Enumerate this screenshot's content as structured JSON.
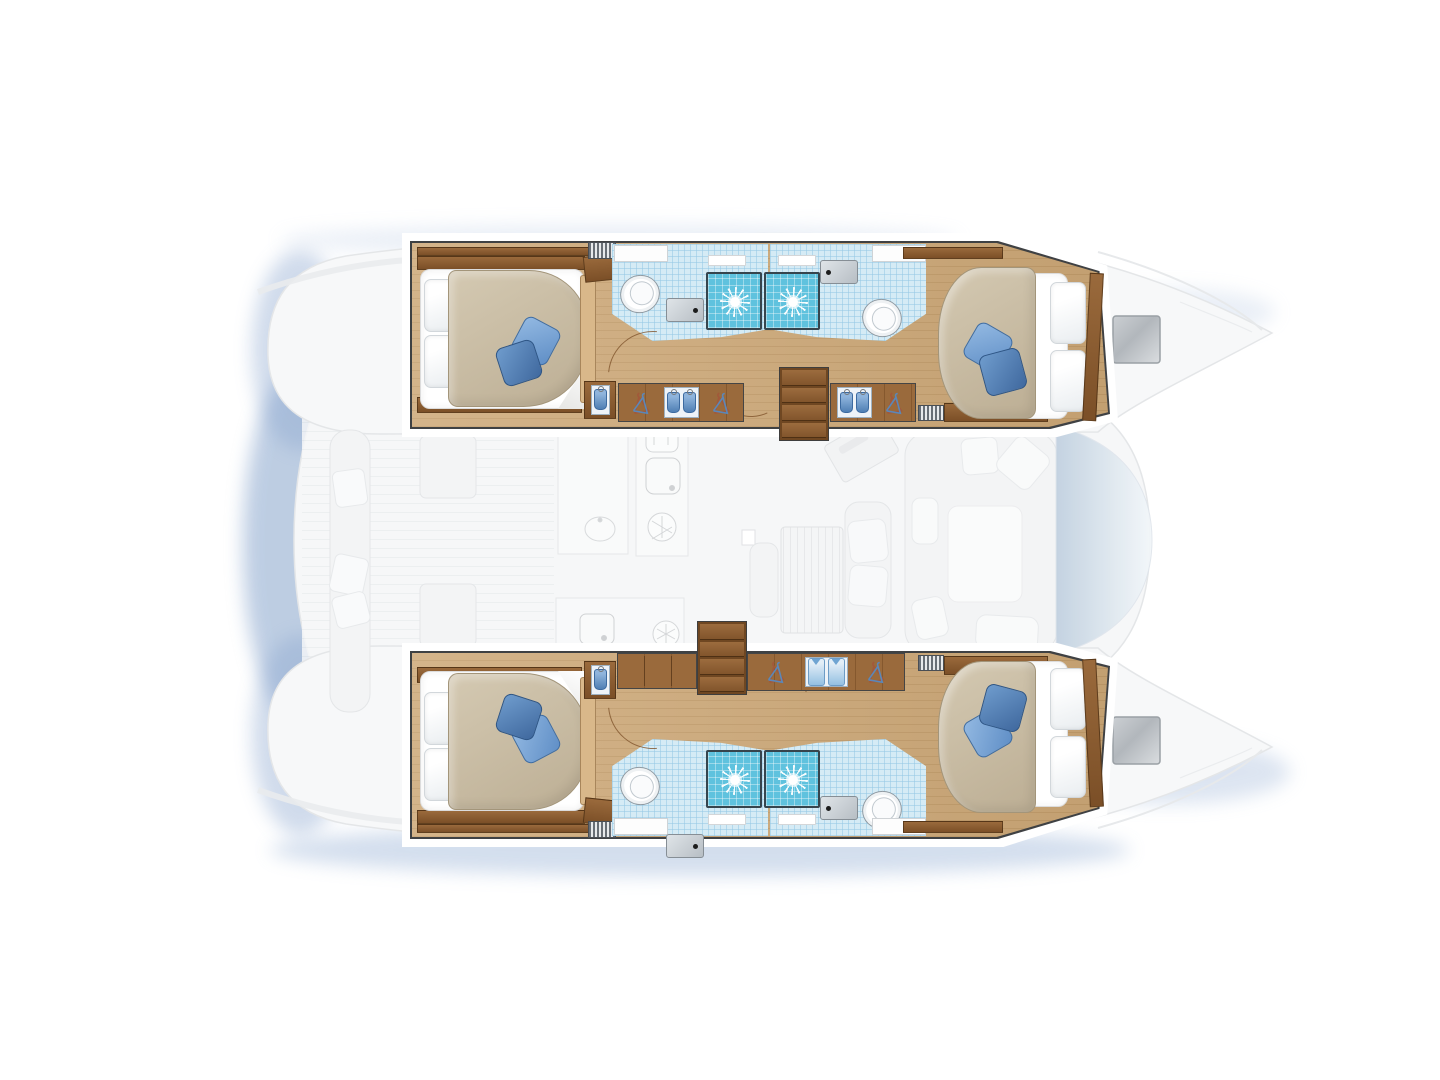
{
  "page": {
    "title": "Catamaran 4-cabin layout — top-view floor plan",
    "view": "top-down, bow to the right",
    "background": "#ffffff"
  },
  "legend": {
    "hulls": 2,
    "double_cabins": 4,
    "bathrooms": 4,
    "showers": 4,
    "toilets": 4,
    "sinks": 4,
    "companionway_steps": 2
  },
  "palette": {
    "wood_floor": "#c9a26e",
    "wood_dark": "#7b4f27",
    "bath_tile": "#d5ebf5",
    "shower_tile": "#5fc2de",
    "cushion_blue_light": "#6f9dd1",
    "cushion_blue_dark": "#40699f",
    "duvet_beige": "#c8bda6",
    "linen_white": "#ffffff",
    "ghost_deck": "#f6f7f8",
    "ghost_line": "#e4e6e8",
    "glass_blue": "#bfcfdf",
    "shadow_blue": "#7d9cc7",
    "outline_dark": "#3f4143"
  },
  "rooms": {
    "port_hull": {
      "label": "Port hull (top)",
      "aft_cabin": "Port aft double cabin",
      "fwd_cabin": "Port forward double cabin",
      "aft_bath": "Port aft bathroom with shower",
      "fwd_bath": "Port forward bathroom with shower",
      "entry": "Port companionway steps",
      "wardrobe": "Port hanging lockers"
    },
    "starboard_hull": {
      "label": "Starboard hull (bottom)",
      "aft_cabin": "Starboard aft double cabin",
      "fwd_cabin": "Starboard forward double cabin",
      "aft_bath": "Starboard aft bathroom with shower",
      "fwd_bath": "Starboard forward bathroom with shower",
      "entry": "Starboard companionway steps",
      "wardrobe": "Starboard hanging lockers"
    },
    "saloon": "Saloon and galley (deck level, ghosted)",
    "cockpit": "Aft cockpit (ghosted)",
    "foredeck": "Foredeck and bows (ghosted)"
  },
  "icons": [
    "shower-rose-icon",
    "toilet-icon",
    "sink-icon",
    "hanger-icon",
    "shirt-icon",
    "towel-icon",
    "vent-grille-icon",
    "cutlery-icon",
    "snowflake-icon",
    "galley-sink-icon",
    "steps-icon",
    "deck-hatch-icon",
    "door-swing-icon",
    "bench-icon",
    "table-icon",
    "sofa-icon",
    "windshield-icon"
  ]
}
